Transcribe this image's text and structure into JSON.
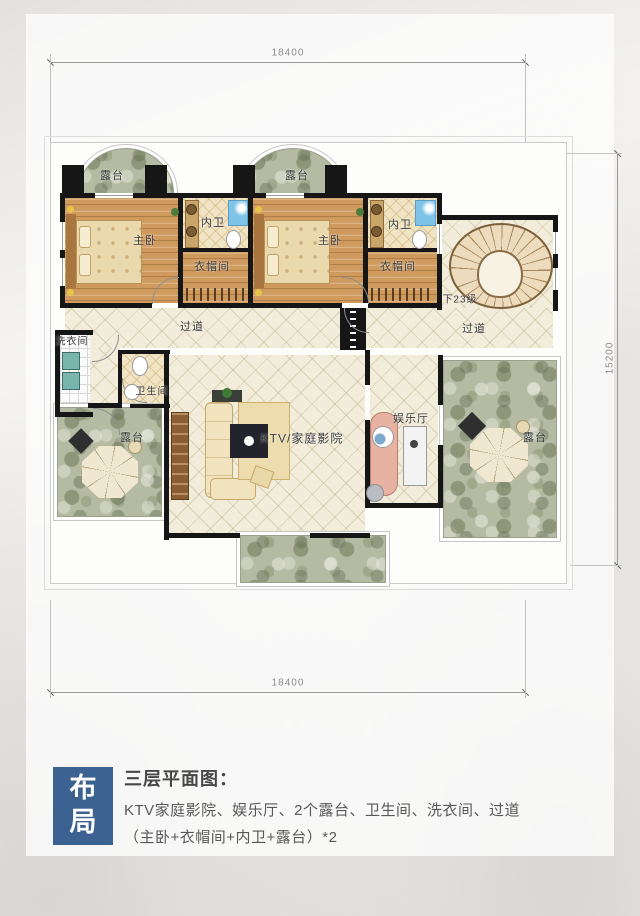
{
  "colors": {
    "accent_blue": "#3c6292",
    "wall_black": "#161616",
    "wood_floor": "#cf9a5e",
    "stone_terrace": "#b5bba2",
    "cream_floor": "#f2ecda",
    "dim_gray": "#8a8a8a"
  },
  "dims": {
    "top": "18400",
    "bottom": "18400",
    "side": "15200"
  },
  "labels": {
    "terrace": "露台",
    "master": "主卧",
    "inner_bath": "内卫",
    "closet": "衣帽间",
    "corridor": "过道",
    "laundry": "洗衣间",
    "bathroom": "卫生间",
    "ktv": "KTV/家庭影院",
    "entertainment": "娱乐厅",
    "stairs_note": "下23级"
  },
  "legend": {
    "badge": "布局",
    "title": "三层平面图：",
    "desc_line1": "KTV家庭影院、娱乐厅、2个露台、卫生间、洗衣间、过道",
    "desc_line2": "（主卧+衣帽间+内卫+露台）*2"
  }
}
